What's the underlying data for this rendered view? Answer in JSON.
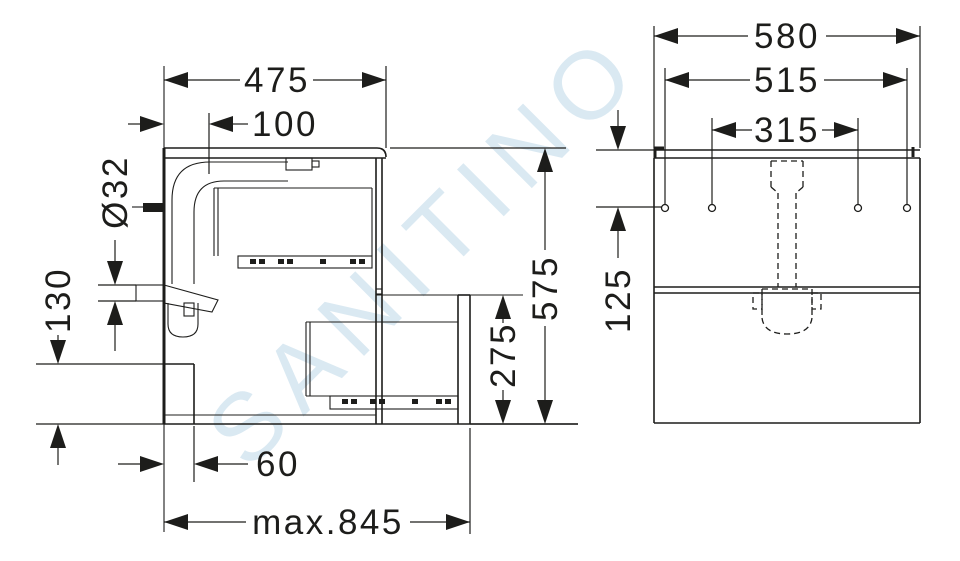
{
  "drawing": {
    "watermark": "SANITINO",
    "side_view": {
      "depth": "475",
      "waste_wall_offset": "100",
      "pipe_diameter": "Ø32",
      "cutout_height": "130",
      "cutout_depth": "60",
      "max_pullout": "max.845",
      "height": "575",
      "lower_front_height": "275"
    },
    "front_view": {
      "width": "580",
      "hole_span_outer": "515",
      "hole_span_inner": "315",
      "hole_top_offset": "125"
    }
  },
  "colors": {
    "line": "#1d1d1b",
    "watermark": "#dae9f2",
    "background": "#ffffff"
  }
}
